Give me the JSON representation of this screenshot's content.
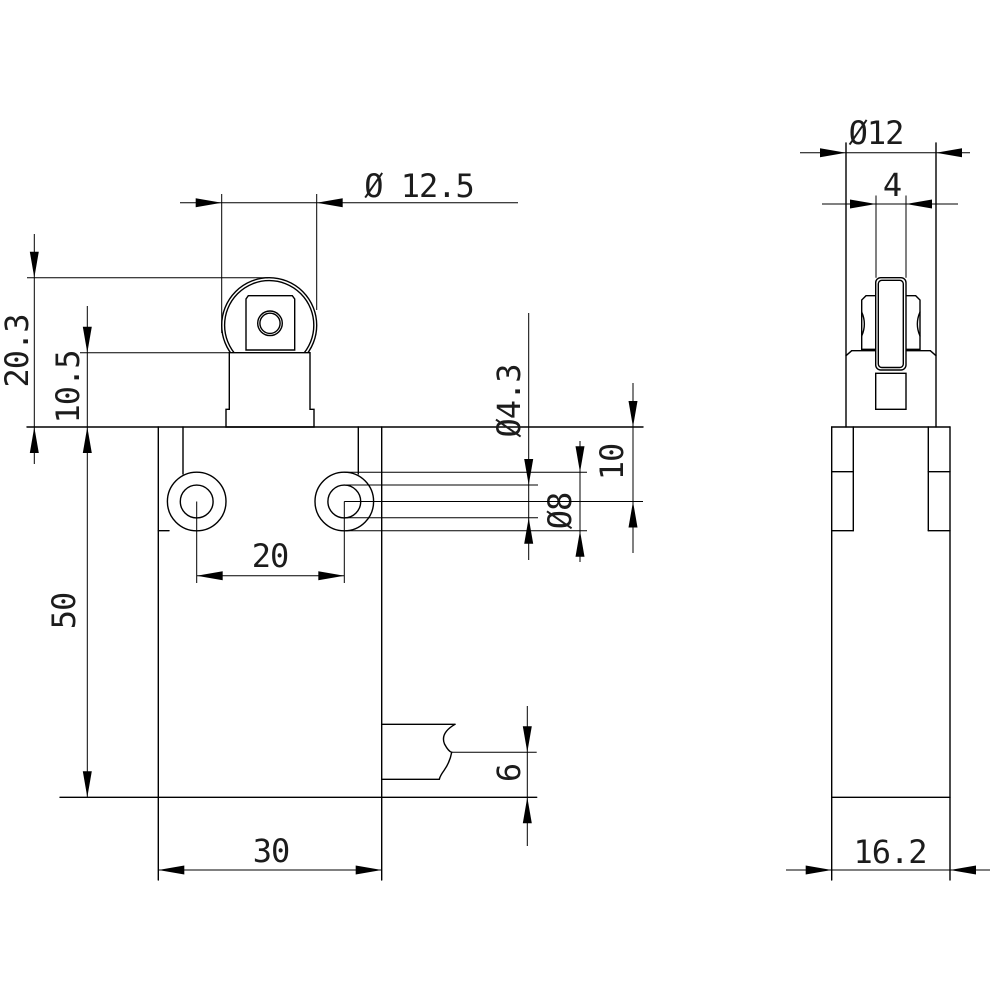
{
  "drawing": {
    "background_color": "#ffffff",
    "line_color": "#000000",
    "dims": {
      "roller_diameter": {
        "label": "Ø 12.5"
      },
      "roller_top_height": {
        "label": "20.3"
      },
      "plunger_height": {
        "label": "10.5"
      },
      "body_height": {
        "label": "50"
      },
      "hole_spacing": {
        "label": "20"
      },
      "body_width": {
        "label": "30"
      },
      "hole_inner_diameter": {
        "label": "Ø4.3"
      },
      "hole_outer_diameter": {
        "label": "Ø8"
      },
      "hole_center_offset": {
        "label": "10"
      },
      "outlet_offset": {
        "label": "6"
      },
      "side_roller_diameter": {
        "label": "Ø12"
      },
      "roller_thickness": {
        "label": "4"
      },
      "side_body_width": {
        "label": "16.2"
      }
    }
  }
}
